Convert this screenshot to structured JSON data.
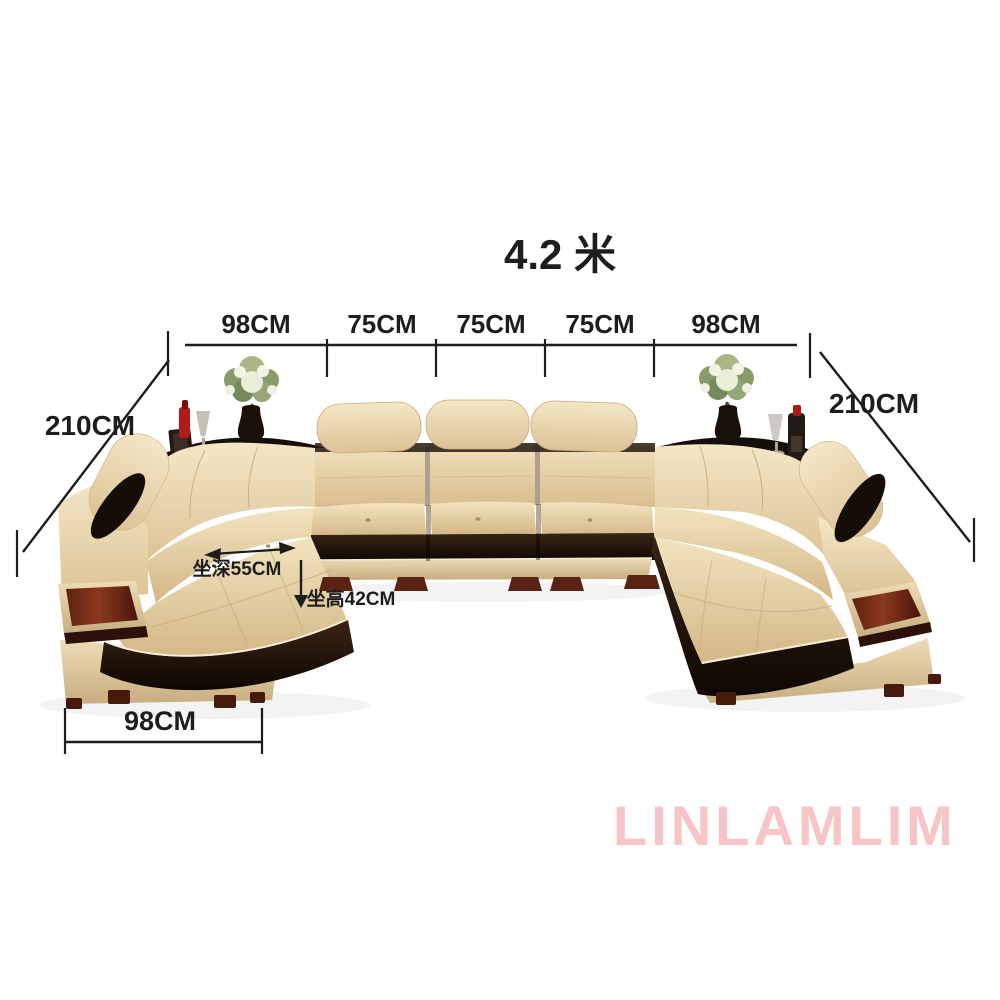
{
  "watermark": "LINLAMLIM",
  "annotations": {
    "total_width": "4.2 米",
    "top_segments": [
      {
        "label": "98CM"
      },
      {
        "label": "75CM"
      },
      {
        "label": "75CM"
      },
      {
        "label": "75CM"
      },
      {
        "label": "98CM"
      }
    ],
    "left_side_depth": "210CM",
    "right_side_depth": "210CM",
    "seat_depth": "坐深55CM",
    "seat_height": "坐高42CM",
    "chaise_width": "98CM"
  },
  "colors": {
    "annotation_text": "#1d1d1d",
    "watermark_pink": "#f7c5c5",
    "leather_cream": "#e9d6ae",
    "trim_dark_leather": "#17100a",
    "wood_panel_maroon": "#7a2f18",
    "flower_accent_red": "#b21919",
    "background": "#ffffff"
  }
}
